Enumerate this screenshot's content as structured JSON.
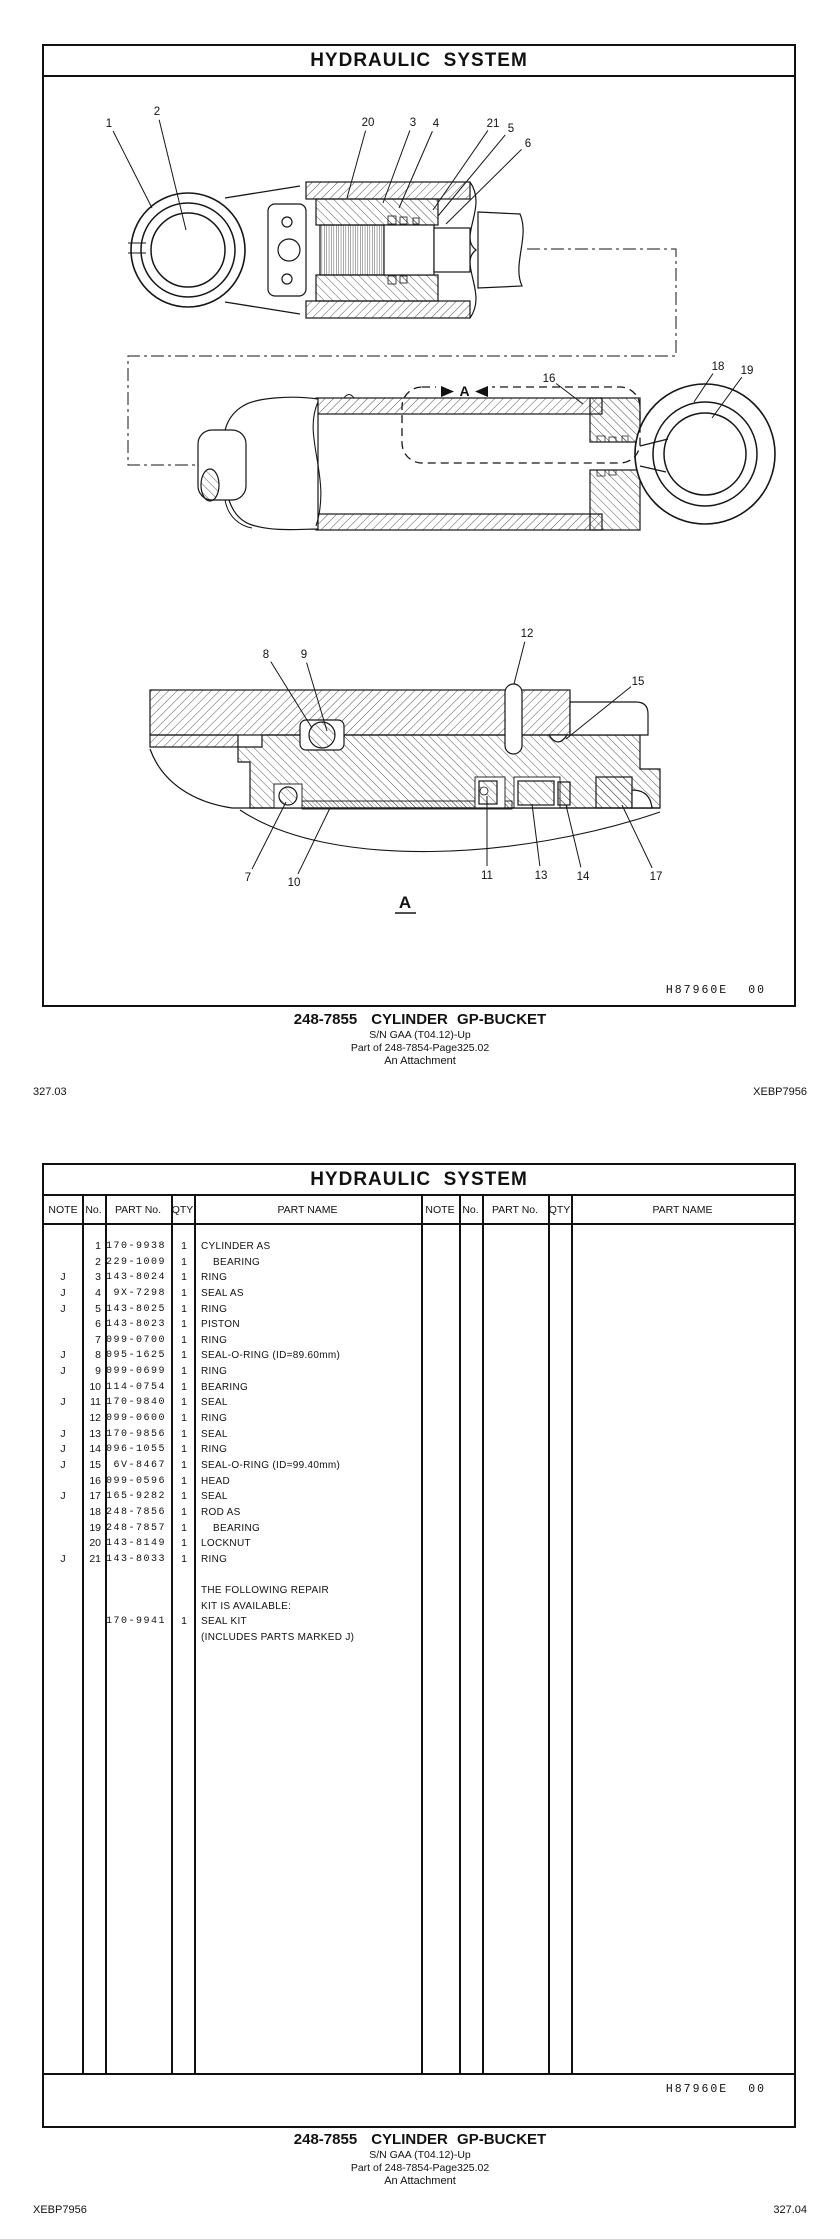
{
  "page1": {
    "title": "HYDRAULIC  SYSTEM",
    "plate_code": "H87960E",
    "plate_rev": "00",
    "caption": {
      "part_number": "248-7855",
      "name": "CYLINDER GP-BUCKET",
      "serial": "S/N GAA (T04.12)-Up",
      "parent": "Part of 248-7854-Page325.02",
      "attachment": "An Attachment"
    },
    "footer_left": "327.03",
    "footer_right": "XEBP7956",
    "drawing": {
      "section_label": "A",
      "section_marker": "A",
      "callouts": [
        {
          "n": "1",
          "x": 109,
          "y": 121,
          "tx": 152,
          "ty": 206
        },
        {
          "n": "2",
          "x": 157,
          "y": 109,
          "tx": 186,
          "ty": 228
        },
        {
          "n": "20",
          "x": 368,
          "y": 120,
          "tx": 347,
          "ty": 196
        },
        {
          "n": "3",
          "x": 413,
          "y": 120,
          "tx": 383,
          "ty": 201
        },
        {
          "n": "4",
          "x": 436,
          "y": 121,
          "tx": 399,
          "ty": 206
        },
        {
          "n": "21",
          "x": 493,
          "y": 121,
          "tx": 433,
          "ty": 208
        },
        {
          "n": "5",
          "x": 511,
          "y": 126,
          "tx": 438,
          "ty": 214
        },
        {
          "n": "6",
          "x": 528,
          "y": 141,
          "tx": 446,
          "ty": 222
        },
        {
          "n": "16",
          "x": 549,
          "y": 376,
          "tx": 583,
          "ty": 402
        },
        {
          "n": "18",
          "x": 718,
          "y": 364,
          "tx": 694,
          "ty": 400
        },
        {
          "n": "19",
          "x": 747,
          "y": 368,
          "tx": 712,
          "ty": 416
        },
        {
          "n": "12",
          "x": 527,
          "y": 631,
          "tx": 514,
          "ty": 682
        },
        {
          "n": "8",
          "x": 266,
          "y": 652,
          "tx": 312,
          "ty": 726
        },
        {
          "n": "9",
          "x": 304,
          "y": 652,
          "tx": 327,
          "ty": 729
        },
        {
          "n": "15",
          "x": 638,
          "y": 679,
          "tx": 566,
          "ty": 737
        },
        {
          "n": "7",
          "x": 248,
          "y": 875,
          "tx": 286,
          "ty": 800
        },
        {
          "n": "10",
          "x": 294,
          "y": 880,
          "tx": 330,
          "ty": 806
        },
        {
          "n": "11",
          "x": 487,
          "y": 873,
          "tx": 487,
          "ty": 794
        },
        {
          "n": "13",
          "x": 541,
          "y": 873,
          "tx": 532,
          "ty": 802
        },
        {
          "n": "14",
          "x": 583,
          "y": 874,
          "tx": 566,
          "ty": 803
        },
        {
          "n": "17",
          "x": 656,
          "y": 874,
          "tx": 622,
          "ty": 803
        }
      ]
    }
  },
  "page2": {
    "title": "HYDRAULIC  SYSTEM",
    "plate_code": "H87960E",
    "plate_rev": "00",
    "caption": {
      "part_number": "248-7855",
      "name": "CYLINDER GP-BUCKET",
      "serial": "S/N GAA (T04.12)-Up",
      "parent": "Part of 248-7854-Page325.02",
      "attachment": "An Attachment"
    },
    "footer_left": "XEBP7956",
    "footer_right": "327.04",
    "table": {
      "headers": [
        "NOTE",
        "No.",
        "PART No.",
        "QTY",
        "PART NAME"
      ],
      "rows": [
        {
          "note": "",
          "no": "1",
          "part_no": "170-9938",
          "qty": "1",
          "name": "CYLINDER AS",
          "indent": 0
        },
        {
          "note": "",
          "no": "2",
          "part_no": "229-1009",
          "qty": "1",
          "name": "BEARING",
          "indent": 1
        },
        {
          "note": "J",
          "no": "3",
          "part_no": "143-8024",
          "qty": "1",
          "name": "RING",
          "indent": 0
        },
        {
          "note": "J",
          "no": "4",
          "part_no": "9X-7298",
          "qty": "1",
          "name": "SEAL AS",
          "indent": 0
        },
        {
          "note": "J",
          "no": "5",
          "part_no": "143-8025",
          "qty": "1",
          "name": "RING",
          "indent": 0
        },
        {
          "note": "",
          "no": "6",
          "part_no": "143-8023",
          "qty": "1",
          "name": "PISTON",
          "indent": 0
        },
        {
          "note": "",
          "no": "7",
          "part_no": "099-0700",
          "qty": "1",
          "name": "RING",
          "indent": 0
        },
        {
          "note": "J",
          "no": "8",
          "part_no": "095-1625",
          "qty": "1",
          "name": "SEAL-O-RING (ID=89.60mm)",
          "indent": 0
        },
        {
          "note": "J",
          "no": "9",
          "part_no": "099-0699",
          "qty": "1",
          "name": "RING",
          "indent": 0
        },
        {
          "note": "",
          "no": "10",
          "part_no": "114-0754",
          "qty": "1",
          "name": "BEARING",
          "indent": 0
        },
        {
          "note": "J",
          "no": "11",
          "part_no": "170-9840",
          "qty": "1",
          "name": "SEAL",
          "indent": 0
        },
        {
          "note": "",
          "no": "12",
          "part_no": "099-0600",
          "qty": "1",
          "name": "RING",
          "indent": 0
        },
        {
          "note": "J",
          "no": "13",
          "part_no": "170-9856",
          "qty": "1",
          "name": "SEAL",
          "indent": 0
        },
        {
          "note": "J",
          "no": "14",
          "part_no": "096-1055",
          "qty": "1",
          "name": "RING",
          "indent": 0
        },
        {
          "note": "J",
          "no": "15",
          "part_no": "6V-8467",
          "qty": "1",
          "name": "SEAL-O-RING (ID=99.40mm)",
          "indent": 0
        },
        {
          "note": "",
          "no": "16",
          "part_no": "099-0596",
          "qty": "1",
          "name": "HEAD",
          "indent": 0
        },
        {
          "note": "J",
          "no": "17",
          "part_no": "165-9282",
          "qty": "1",
          "name": "SEAL",
          "indent": 0
        },
        {
          "note": "",
          "no": "18",
          "part_no": "248-7856",
          "qty": "1",
          "name": "ROD AS",
          "indent": 0
        },
        {
          "note": "",
          "no": "19",
          "part_no": "248-7857",
          "qty": "1",
          "name": "BEARING",
          "indent": 1
        },
        {
          "note": "",
          "no": "20",
          "part_no": "143-8149",
          "qty": "1",
          "name": "LOCKNUT",
          "indent": 0
        },
        {
          "note": "J",
          "no": "21",
          "part_no": "143-8033",
          "qty": "1",
          "name": "RING",
          "indent": 0
        },
        {
          "note": "",
          "no": "",
          "part_no": "",
          "qty": "",
          "name": "",
          "indent": 0
        },
        {
          "note": "",
          "no": "",
          "part_no": "",
          "qty": "",
          "name": "THE FOLLOWING REPAIR",
          "indent": 0
        },
        {
          "note": "",
          "no": "",
          "part_no": "",
          "qty": "",
          "name": "KIT IS AVAILABLE:",
          "indent": 0
        },
        {
          "note": "",
          "no": "",
          "part_no": "170-9941",
          "qty": "1",
          "name": "SEAL KIT",
          "indent": 0
        },
        {
          "note": "",
          "no": "",
          "part_no": "",
          "qty": "",
          "name": "(INCLUDES PARTS MARKED J)",
          "indent": 0
        }
      ]
    }
  }
}
